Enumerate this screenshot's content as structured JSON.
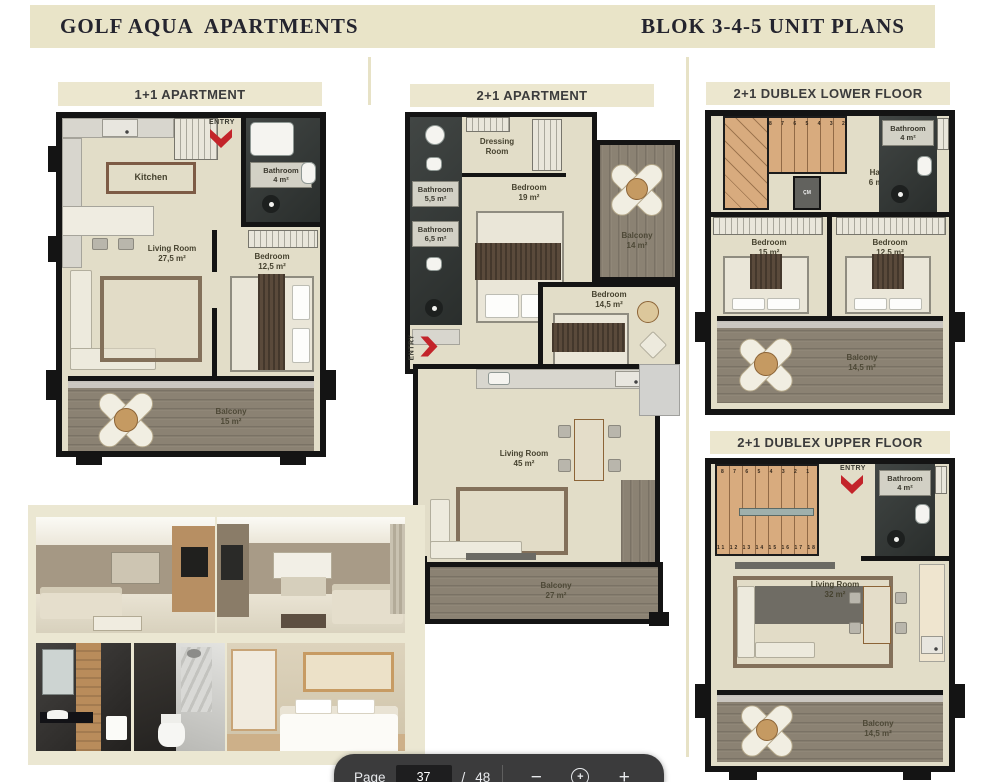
{
  "header": {
    "left_title": "GOLF AQUA  APARTMENTS",
    "right_title": "BLOK 3-4-5 UNIT PLANS"
  },
  "plans": {
    "p11": {
      "title": "1+1 APARTMENT",
      "entry": "ENTRY",
      "rooms": {
        "kitchen": {
          "name": "Kitchen"
        },
        "living": {
          "name": "Living Room",
          "area": "27,5 m²"
        },
        "bathroom": {
          "name": "Bathroom",
          "area": "4 m²"
        },
        "bedroom": {
          "name": "Bedroom",
          "area": "12,5 m²"
        },
        "balcony": {
          "name": "Balcony",
          "area": "15 m²"
        }
      }
    },
    "p21": {
      "title": "2+1 APARTMENT",
      "entry": "ENTRY",
      "rooms": {
        "dressing": {
          "name": "Dressing",
          "name2": "Room"
        },
        "bath1": {
          "name": "Bathroom",
          "area": "5,5 m²"
        },
        "bath2": {
          "name": "Bathroom",
          "area": "6,5 m²"
        },
        "bedroom1": {
          "name": "Bedroom",
          "area": "19 m²"
        },
        "balcony1": {
          "name": "Balcony",
          "area": "14 m²"
        },
        "bedroom2": {
          "name": "Bedroom",
          "area": "14,5 m²"
        },
        "living": {
          "name": "Living Room",
          "area": "45 m²"
        },
        "balcony2": {
          "name": "Balcony",
          "area": "27 m²"
        }
      }
    },
    "lower": {
      "title": "2+1 DUBLEX LOWER FLOOR",
      "stair_numbers": "8 7 6 5 4 3 2 1",
      "closet": "ÇM",
      "rooms": {
        "hall": {
          "name": "Hall",
          "area": "6 m²"
        },
        "bathroom": {
          "name": "Bathroom",
          "area": "4 m²"
        },
        "bedroom1": {
          "name": "Bedroom",
          "area": "15 m²"
        },
        "bedroom2": {
          "name": "Bedroom",
          "area": "12,5 m²"
        },
        "balcony": {
          "name": "Balcony",
          "area": "14,5 m²"
        }
      }
    },
    "upper": {
      "title": "2+1 DUBLEX UPPER FLOOR",
      "entry": "ENTRY",
      "stair_numbers": "8 7 6 5 4 3 2 1",
      "stair_numbers_bottom": "11 12 13 14 15 16 17 18",
      "rooms": {
        "bathroom": {
          "name": "Bathroom",
          "area": "4 m²"
        },
        "living": {
          "name": "Living Room",
          "area": "32 m²"
        },
        "balcony": {
          "name": "Balcony",
          "area": "14,5 m²"
        }
      }
    }
  },
  "toolbar": {
    "page_label": "Page",
    "current_page": "37",
    "separator": "/",
    "total_pages": "48",
    "zoom_out_glyph": "−",
    "zoom_reset_glyph": "+",
    "zoom_in_glyph": "+"
  },
  "colors": {
    "header_beige": "#e9e4c8",
    "plan_floor": "#e2ddc8",
    "wall_black": "#141414",
    "balcony_wood": "#8b8273",
    "stair_wood": "#d8ab7e",
    "entry_red": "#c3242a",
    "toolbar_dark": "#3b3b3c"
  }
}
